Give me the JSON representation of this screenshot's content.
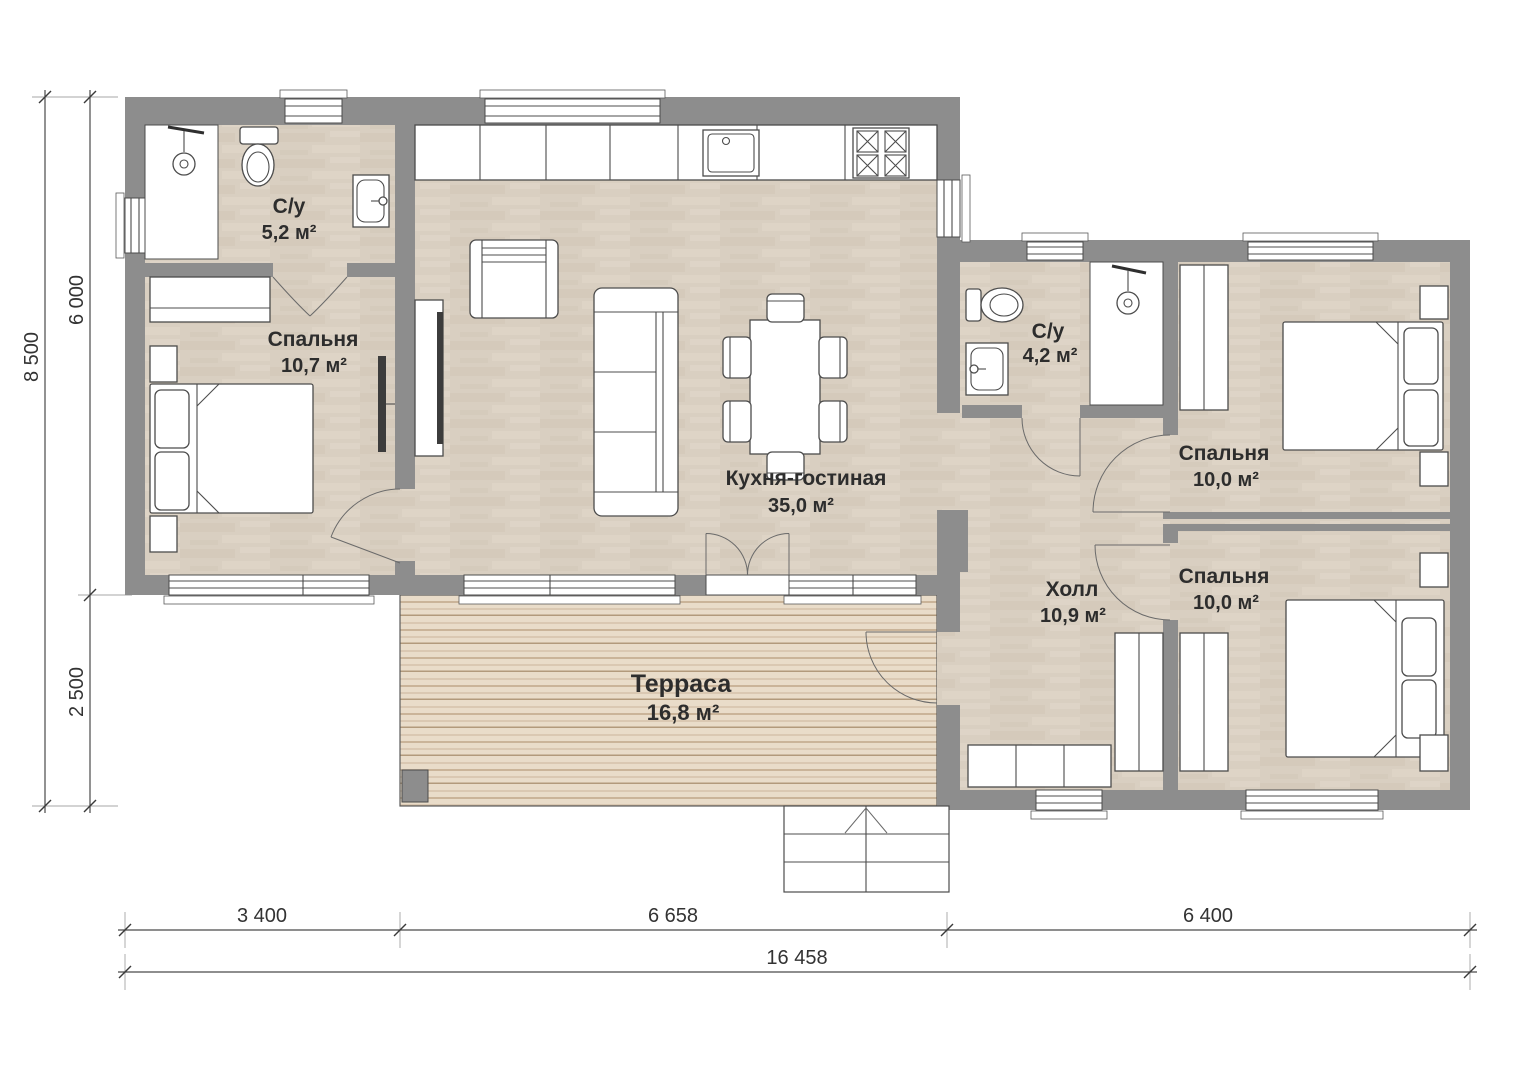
{
  "rooms": {
    "bathroom_left": {
      "name": "С/у",
      "area": "5,2 м²"
    },
    "bedroom_left": {
      "name": "Спальня",
      "area": "10,7 м²"
    },
    "kitchen_living": {
      "name": "Кухня-гостиная",
      "area": "35,0 м²"
    },
    "bathroom_right": {
      "name": "С/у",
      "area": "4,2 м²"
    },
    "bedroom_top_right": {
      "name": "Спальня",
      "area": "10,0 м²"
    },
    "hall": {
      "name": "Холл",
      "area": "10,9 м²"
    },
    "bedroom_bottom_right": {
      "name": "Спальня",
      "area": "10,0 м²"
    },
    "terrace": {
      "name": "Терраса",
      "area": "16,8 м²"
    }
  },
  "dimensions": {
    "height_total": "8 500",
    "height_upper": "6 000",
    "height_lower": "2 500",
    "width_left": "3 400",
    "width_middle": "6 658",
    "width_right": "6 400",
    "width_total": "16 458"
  },
  "colors": {
    "wall": "#8d8d8d",
    "floor": "#d9cfc1",
    "terrace_deck": "#e9dcc9",
    "line": "#4c4c4c"
  }
}
